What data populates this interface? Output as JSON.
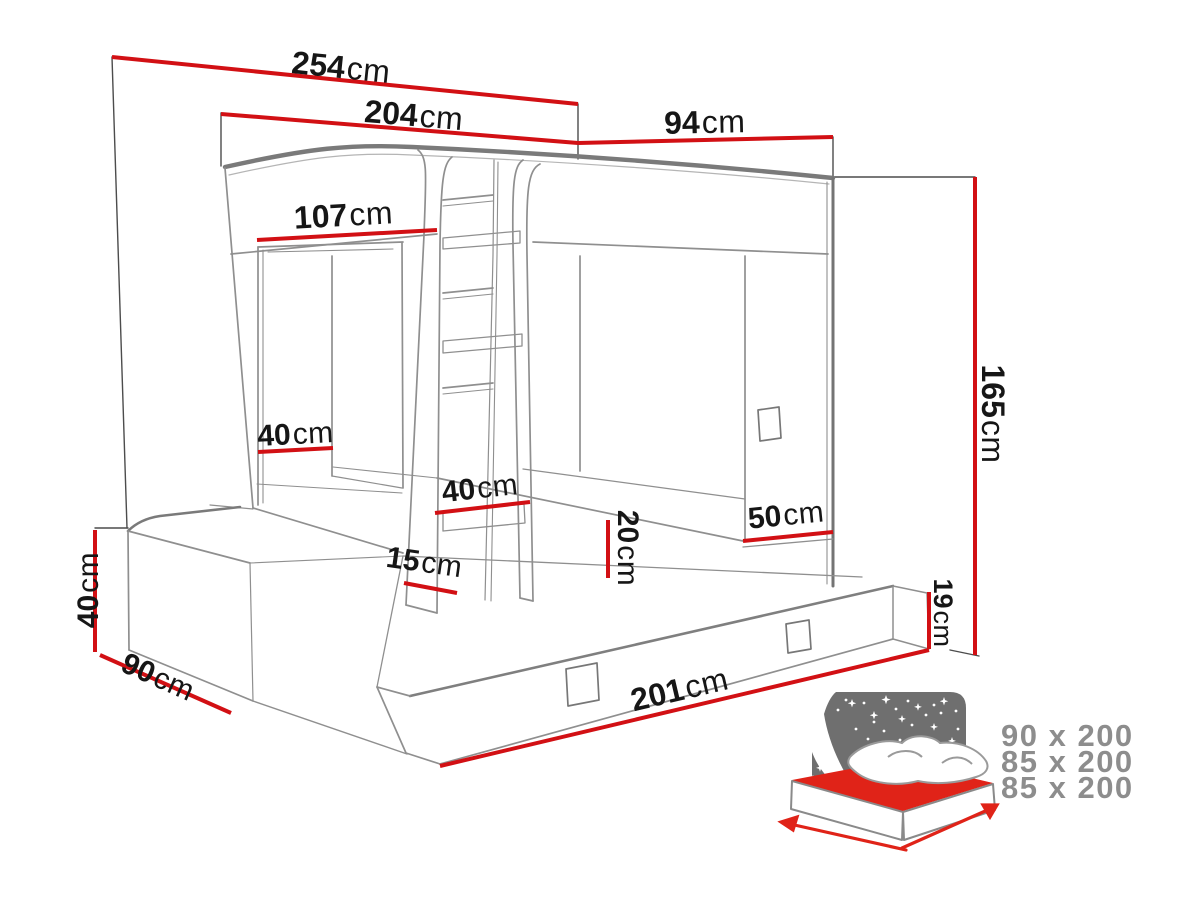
{
  "diagram_type": "furniture-bunk-bed-dimension-drawing",
  "dimensions": {
    "total_width": {
      "value": "254",
      "unit": "cm"
    },
    "upper_cabin_width": {
      "value": "204",
      "unit": "cm"
    },
    "right_section_width": {
      "value": "94",
      "unit": "cm"
    },
    "opening_width": {
      "value": "107",
      "unit": "cm"
    },
    "total_height": {
      "value": "165",
      "unit": "cm"
    },
    "niche_depth": {
      "value": "40",
      "unit": "cm"
    },
    "ladder_width": {
      "value": "40",
      "unit": "cm"
    },
    "ladder_floor_gap": {
      "value": "15",
      "unit": "cm"
    },
    "mattress_step_height": {
      "value": "20",
      "unit": "cm"
    },
    "side_panel_height": {
      "value": "50",
      "unit": "cm"
    },
    "drawer_front_height": {
      "value": "19",
      "unit": "cm"
    },
    "drawer_length": {
      "value": "201",
      "unit": "cm"
    },
    "base_height": {
      "value": "40",
      "unit": "cm"
    },
    "base_depth": {
      "value": "90",
      "unit": "cm"
    }
  },
  "mattress_sizes": {
    "rows": [
      "90 x 200",
      "85 x 200",
      "85 x 200"
    ]
  },
  "colors": {
    "dimension_red": "#d21014",
    "structure_gray": "#8f8f8f",
    "structure_dark": "#7a7a7a",
    "extension_dark": "#4c4c4c",
    "label_text": "#161616",
    "icon_headboard_gray": "#6f6f6f",
    "icon_mattress_red": "#e02318",
    "sizes_text_gray": "#8d8d8d"
  }
}
